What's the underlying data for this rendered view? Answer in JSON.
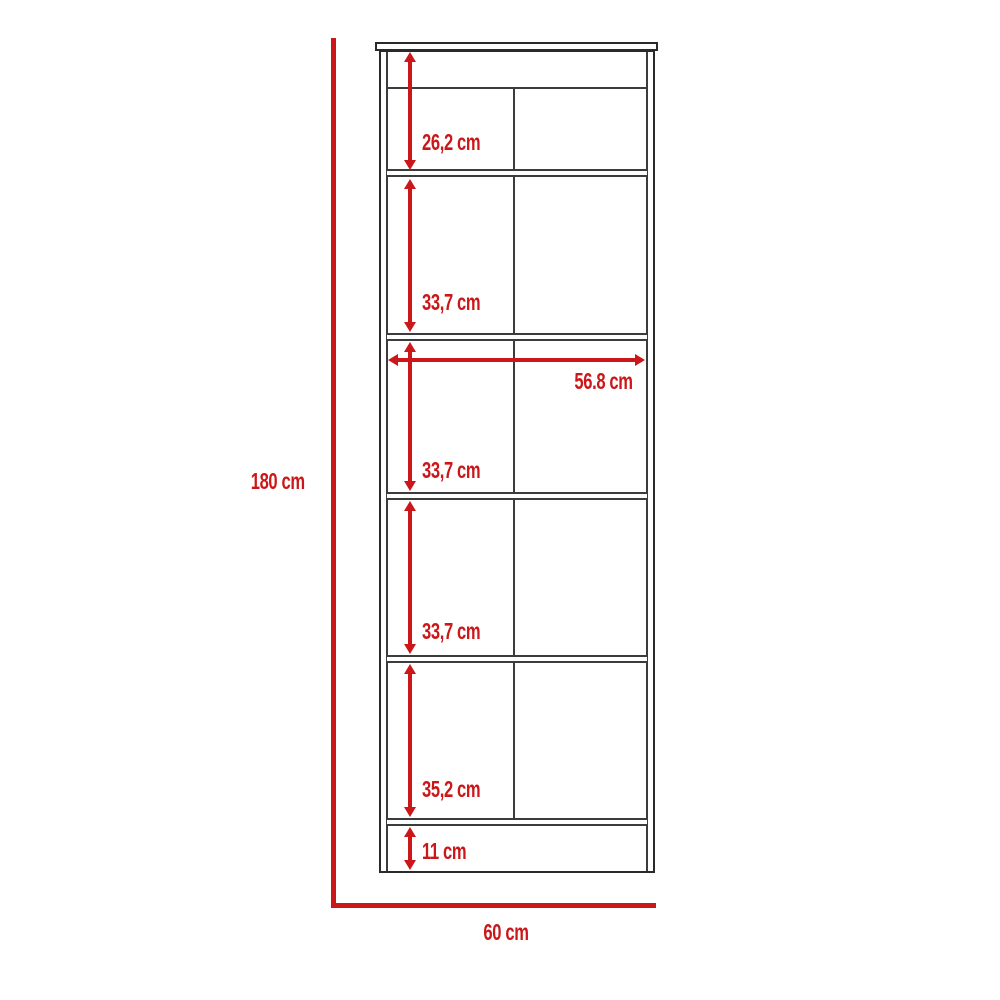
{
  "diagram": {
    "type": "furniture-dimension-drawing",
    "subject": "tall cabinet / linen tower front elevation",
    "unit": "cm",
    "overall": {
      "height_label": "180 cm",
      "width_label": "60 cm",
      "interior_width_label": "56.8 cm"
    },
    "section_heights": [
      {
        "label": "26,2 cm"
      },
      {
        "label": "33,7 cm"
      },
      {
        "label": "33,7 cm"
      },
      {
        "label": "33,7 cm"
      },
      {
        "label": "35,2 cm"
      },
      {
        "label": "11 cm"
      }
    ],
    "shelf_count": 5,
    "colors": {
      "dimension_red": "#cb1719",
      "outline_dark": "#2a2a2a",
      "panel_line": "#3c3c3c",
      "background": "#ffffff"
    }
  }
}
